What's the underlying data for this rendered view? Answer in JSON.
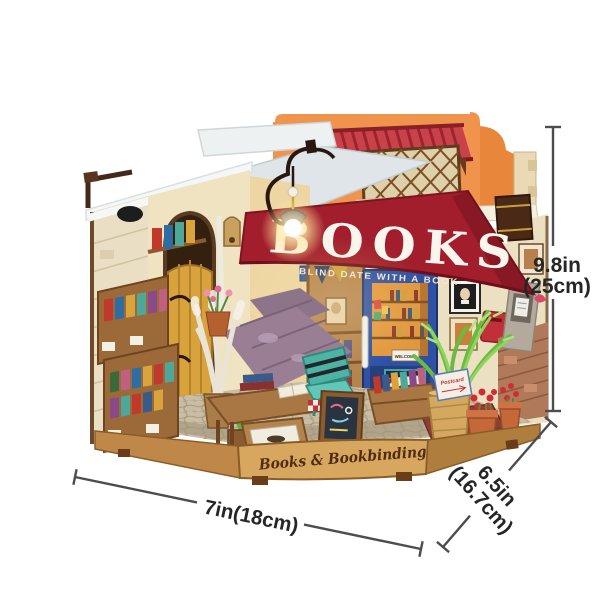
{
  "model": {
    "awning": {
      "title": "BOOKS",
      "subtitle": "BLIND DATE WITH A BOOK"
    },
    "base": {
      "engraving": "Books & Bookbinding"
    },
    "door": {
      "welcome_sign": "WELCOME",
      "open_sign": "OPEN"
    },
    "signs": {
      "postcard": "Postcard"
    }
  },
  "dimensions": {
    "height": {
      "inches": "9.8in",
      "metric": "(25cm)"
    },
    "width": {
      "label": "7in(18cm)"
    },
    "depth": {
      "inches": "6.5in",
      "metric": "(16.7cm)"
    }
  },
  "colors": {
    "background": "#ffffff",
    "awning_red": "#a21e2c",
    "facade_orange": "#f0944d",
    "canopy_red": "#c9424a",
    "door_blue": "#2e51a5",
    "base_wood": "#d8a75f",
    "dimension_line": "#4d4d4d",
    "dimension_text": "#262626"
  }
}
